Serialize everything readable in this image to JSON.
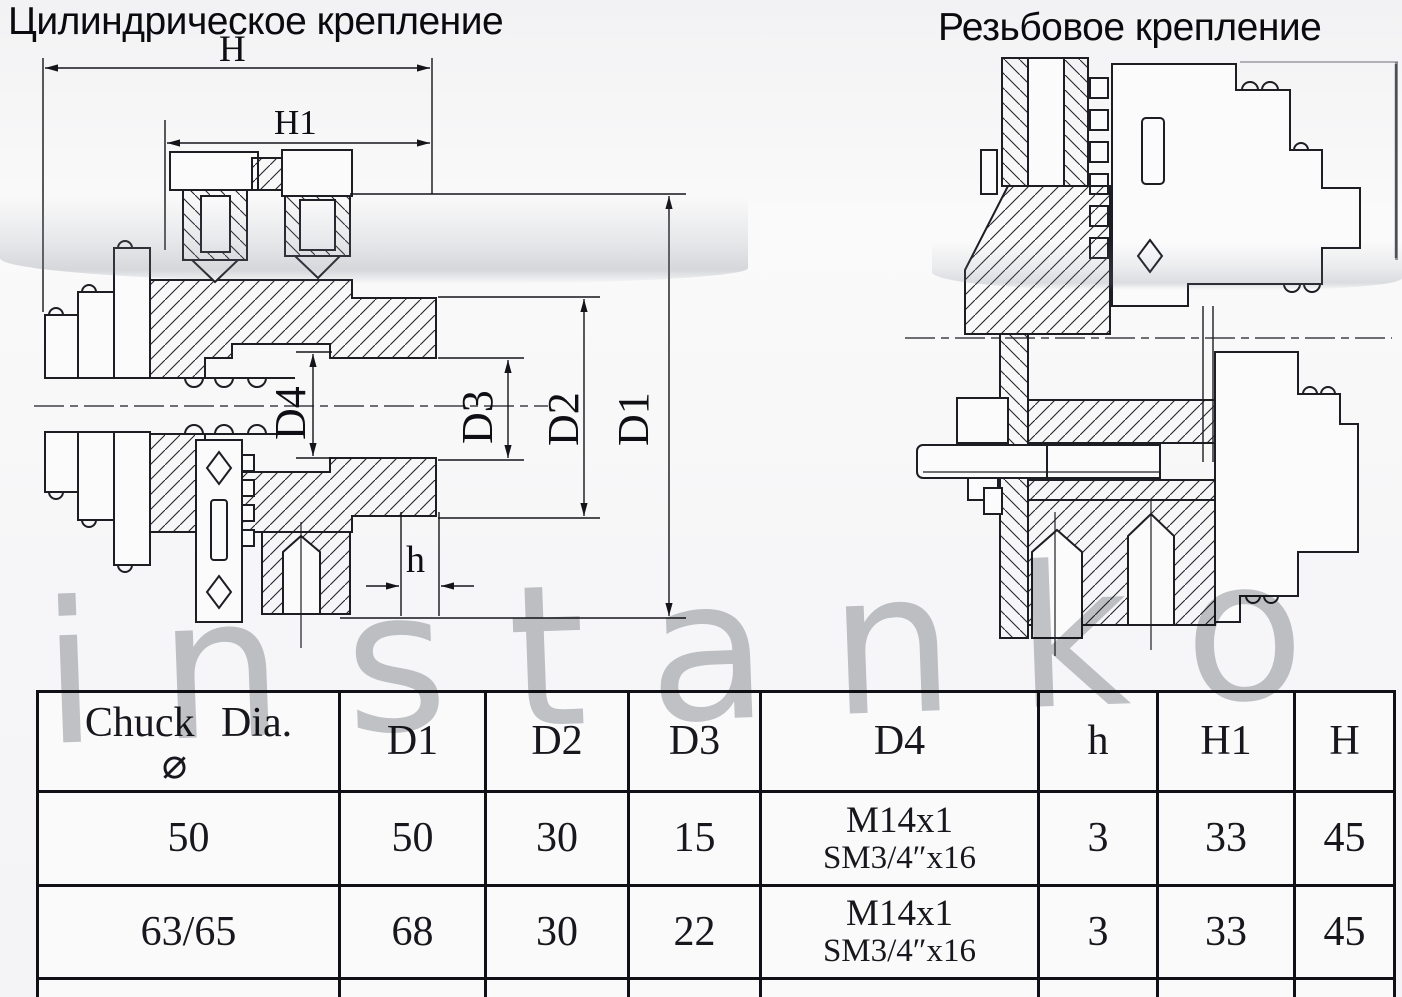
{
  "titles": {
    "left": "Цилиндрическое крепление",
    "right": "Резьбовое крепление"
  },
  "watermark": "instanko",
  "drawings": {
    "left": {
      "name": "chuck cross-section, cylindrical mount",
      "dim_labels": [
        "H",
        "H1",
        "D4",
        "D3",
        "D2",
        "D1",
        "h"
      ]
    },
    "right": {
      "name": "chuck cross-section, threaded mount"
    }
  },
  "table": {
    "diameter_symbol": "⌀",
    "headers": [
      "Chuck Dia.",
      "D1",
      "D2",
      "D3",
      "D4",
      "h",
      "H1",
      "H"
    ],
    "rows": [
      {
        "chuck_dia": "50",
        "d1": "50",
        "d2": "30",
        "d3": "15",
        "d4": [
          "M14x1",
          "SM3/4″x16"
        ],
        "h": "3",
        "h1": "33",
        "H": "45"
      },
      {
        "chuck_dia": "63/65",
        "d1": "68",
        "d2": "30",
        "d3": "22",
        "d4": [
          "M14x1",
          "SM3/4″x16"
        ],
        "h": "3",
        "h1": "33",
        "H": "45"
      }
    ]
  }
}
